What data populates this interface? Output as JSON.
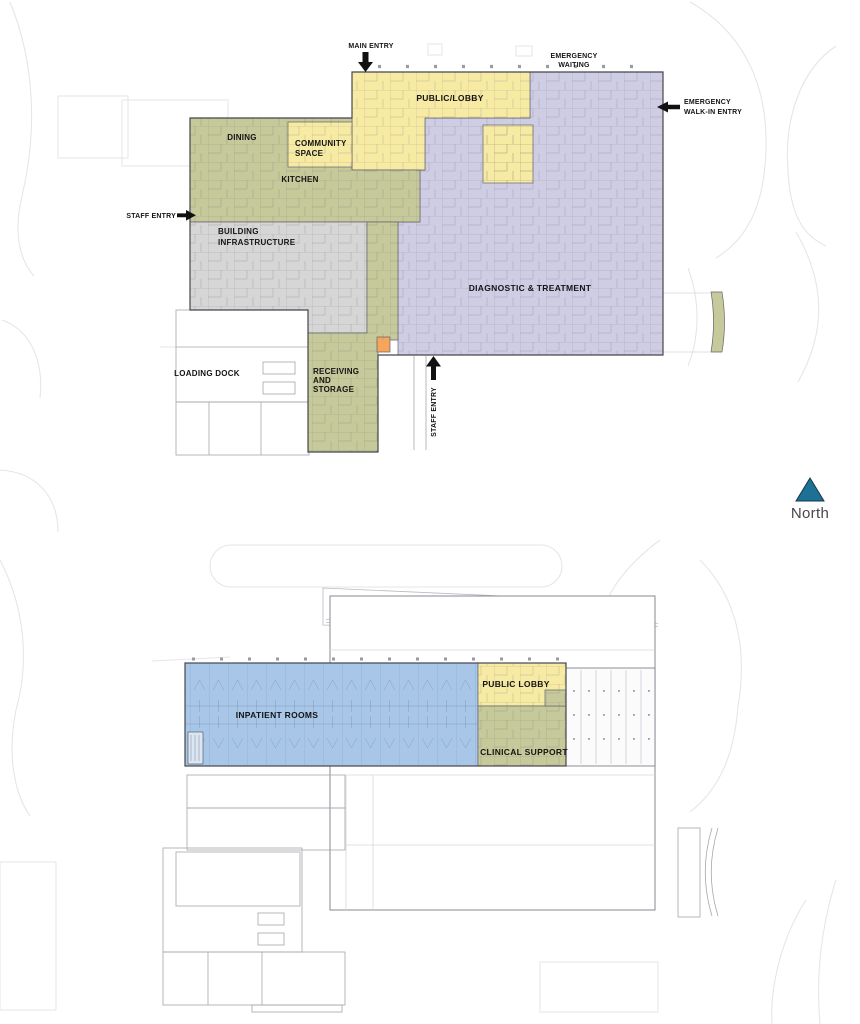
{
  "colors": {
    "public_lobby": "#f7eba4",
    "diagnostic_treatment": "#cfcde4",
    "service_olive": "#c6c99a",
    "building_infrastructure": "#d6d6d7",
    "inpatient_blue": "#a8c7e8",
    "highlight_orange": "#f5a65a",
    "stair_blue": "#dce6f2",
    "north_arrow": "#1e7094",
    "label_text": "#141414"
  },
  "level1": {
    "zones": {
      "public_lobby": "PUBLIC/LOBBY",
      "community_space": [
        "COMMUNITY",
        "SPACE"
      ],
      "dining": "DINING",
      "kitchen": "KITCHEN",
      "building_infrastructure": [
        "BUILDING",
        "INFRASTRUCTURE"
      ],
      "diagnostic_treatment": "DIAGNOSTIC & TREATMENT",
      "receiving_storage": [
        "RECEIVING",
        "AND",
        "STORAGE"
      ],
      "loading_dock": "LOADING DOCK"
    },
    "entries": {
      "main_entry": "MAIN ENTRY",
      "emergency_waiting": [
        "EMERGENCY",
        "WAITING"
      ],
      "emergency_walk_in": [
        "EMERGENCY",
        "WALK-IN ENTRY"
      ],
      "staff_entry_west": "STAFF ENTRY",
      "staff_entry_south": "STAFF ENTRY"
    }
  },
  "level2": {
    "zones": {
      "inpatient_rooms": "INPATIENT ROOMS",
      "public_lobby": "PUBLIC LOBBY",
      "clinical_support": "CLINICAL SUPPORT"
    }
  },
  "compass": {
    "north_label": "North"
  }
}
